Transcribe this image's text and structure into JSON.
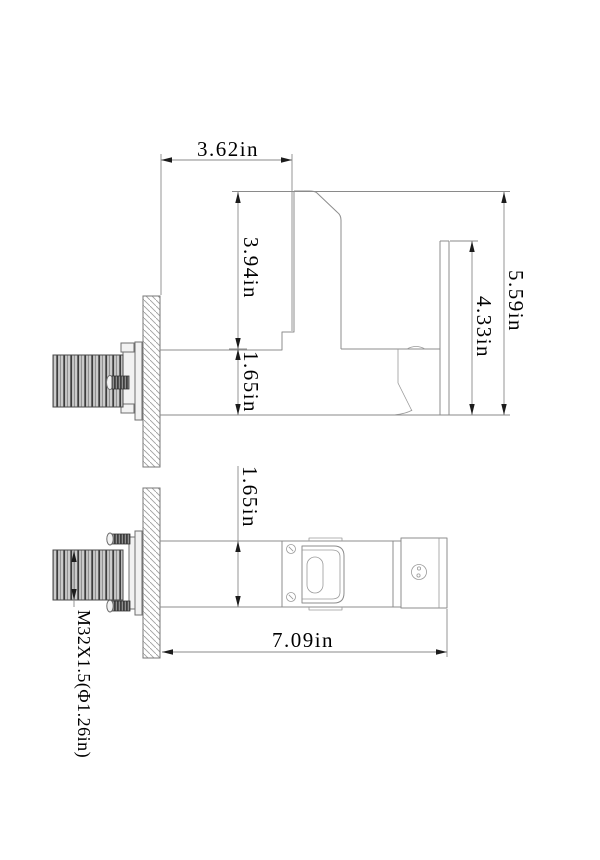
{
  "drawing": {
    "colors": {
      "background": "#ffffff",
      "line": "#8c8c8c",
      "dimension_line": "#8a8a8a",
      "arrow": "#1c1c1c",
      "text": "#000000",
      "hatch": "#a0a0a0"
    },
    "elevation_view": {
      "dim_top_width": "3.62in",
      "dim_spout_height": "3.94in",
      "dim_base_height": "1.65in",
      "dim_handle_height": "4.33in",
      "dim_overall_height": "5.59in"
    },
    "plan_view": {
      "dim_body_width": "1.65in",
      "dim_overall_length": "7.09in",
      "thread_spec": "M32X1.5(Φ1.26in)"
    }
  }
}
